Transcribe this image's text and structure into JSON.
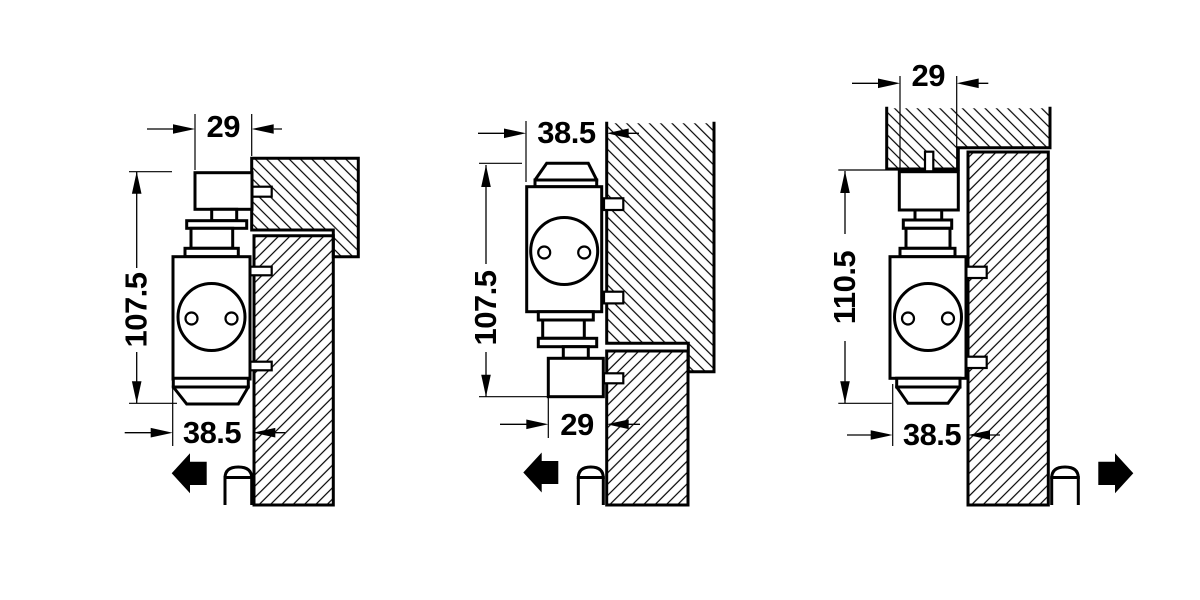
{
  "drawing": {
    "background": "#ffffff",
    "ink": "#000000",
    "diagrams": [
      {
        "name": "door-mounting-pull-side",
        "top": "29",
        "side": "107.5",
        "bottom": "38.5",
        "swing_arrow": "left"
      },
      {
        "name": "transom-mounting",
        "top": "38.5",
        "side": "107.5",
        "bottom": "29",
        "swing_arrow": "left"
      },
      {
        "name": "door-mounting-push-side",
        "top": "29",
        "side": "110.5",
        "bottom": "38.5",
        "swing_arrow": "right"
      }
    ]
  }
}
